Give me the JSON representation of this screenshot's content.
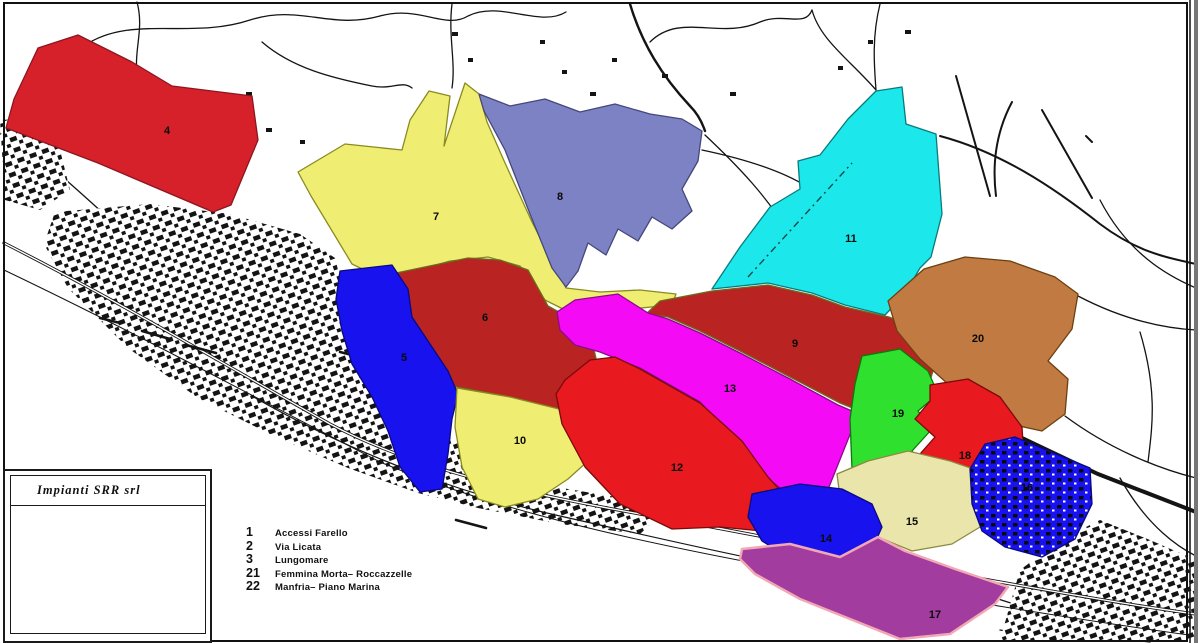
{
  "legend": {
    "title": "Impianti SRR srl",
    "items": [
      {
        "num": "1",
        "label": "Accessi Farello"
      },
      {
        "num": "2",
        "label": "Via Licata"
      },
      {
        "num": "3",
        "label": "Lungomare"
      },
      {
        "num": "21",
        "label": "Femmina Morta– Roccazzelle"
      },
      {
        "num": "22",
        "label": "Manfria– Piano Marina"
      }
    ]
  },
  "map": {
    "frame_color": "#1a1a1a",
    "zones": [
      {
        "id": "7",
        "number": "7",
        "color": "#f0ee72",
        "stroke": "#8a8a20",
        "lx": 436,
        "ly": 220,
        "points": "298,172 345,144 402,150 410,120 429,91 450,96 444,146 465,83 479,94 487,122 505,163 532,222 553,263 566,288 600,292 640,290 676,294 672,305 620,310 578,316 561,308 545,300 520,266 488,257 450,261 415,271 385,280 352,264 311,196"
      },
      {
        "id": "8",
        "number": "8",
        "color": "#7c82c4",
        "stroke": "#44487a",
        "lx": 560,
        "ly": 200,
        "points": "479,94 510,106 545,99 580,112 615,104 650,114 682,119 702,131 698,161 682,189 692,211 672,229 652,217 638,241 618,229 606,255 588,243 578,271 566,287 552,268 530,214 505,150 484,111"
      },
      {
        "id": "11",
        "number": "11",
        "color": "#1ce8ec",
        "stroke": "#0a7a7a",
        "lx": 851,
        "ly": 242,
        "points": "876,91 902,87 906,124 936,134 942,214 931,257 920,268 905,294 885,315 845,305 812,293 768,283 712,289 740,247 770,207 800,189 798,161 820,155 848,119"
      },
      {
        "id": "4",
        "number": "4",
        "color": "#d6202a",
        "stroke": "#8c1620",
        "lx": 167,
        "ly": 134,
        "points": "38,48 78,35 132,62 172,86 252,96 258,140 231,205 213,212 98,163 6,128 14,99"
      },
      {
        "id": "6",
        "number": "6",
        "color": "#b92423",
        "stroke": "#6b6b1f",
        "lx": 485,
        "ly": 321,
        "points": "363,280 420,268 468,258 500,260 528,270 548,306 575,321 592,341 598,367 588,383 566,381 563,410 510,397 457,387 420,377 400,354 382,317"
      },
      {
        "id": "5",
        "number": "5",
        "color": "#1712ee",
        "stroke": "#0a0a80",
        "lx": 404,
        "ly": 361,
        "points": "340,271 392,265 408,289 412,317 430,344 448,371 458,394 452,419 448,454 442,489 420,492 400,467 388,431 372,397 352,364 342,331 336,299"
      },
      {
        "id": "9",
        "number": "9",
        "color": "#b92423",
        "stroke": "#6b6b1f",
        "lx": 795,
        "ly": 347,
        "points": "712,291 768,285 812,295 845,307 889,317 920,329 940,347 930,381 903,397 885,421 840,403 790,377 740,351 700,331 668,317 646,314 660,301"
      },
      {
        "id": "20",
        "number": "20",
        "color": "#c17a41",
        "stroke": "#6b4010",
        "lx": 978,
        "ly": 342,
        "points": "888,301 924,269 965,257 1010,261 1055,277 1078,294 1072,329 1048,361 1068,379 1065,414 1042,431 1010,424 978,407 948,384 920,359 897,331"
      },
      {
        "id": "13",
        "number": "13",
        "color": "#f50af5",
        "stroke": "#8a0a8a",
        "lx": 730,
        "ly": 392,
        "points": "575,300 618,294 648,313 668,319 700,333 740,353 790,379 838,405 880,423 853,427 827,492 795,500 770,480 745,450 700,402 640,368 600,352 575,345 560,330 557,312"
      },
      {
        "id": "10",
        "number": "10",
        "color": "#f0ee72",
        "stroke": "#8a8a20",
        "lx": 520,
        "ly": 444,
        "points": "457,388 510,397 563,410 588,407 596,431 588,461 568,479 538,499 505,507 478,499 462,467 455,427"
      },
      {
        "id": "12",
        "number": "12",
        "color": "#e8191f",
        "stroke": "#7a0a0a",
        "lx": 677,
        "ly": 471,
        "points": "565,380 590,360 615,357 640,369 700,403 742,441 768,477 790,501 762,531 720,527 672,529 620,504 585,467 562,424 556,394"
      },
      {
        "id": "19",
        "number": "19",
        "color": "#30e02e",
        "stroke": "#0a7a0a",
        "lx": 898,
        "ly": 417,
        "points": "862,356 900,349 928,371 938,394 918,411 932,429 912,451 928,469 905,491 885,511 868,531 858,509 852,469 850,419 855,384"
      },
      {
        "id": "18",
        "number": "18",
        "color": "#e8191f",
        "stroke": "#7a0a0a",
        "lx": 965,
        "ly": 459,
        "points": "930,385 968,379 1000,397 1022,427 1024,459 1005,489 972,499 940,491 938,469 920,454 935,437 915,419 930,401"
      },
      {
        "id": "15",
        "number": "15",
        "color": "#eae5ab",
        "stroke": "#8a8a40",
        "lx": 912,
        "ly": 525,
        "points": "837,474 868,461 908,451 950,461 988,474 1000,497 985,524 952,544 912,551 878,537 855,514 840,497"
      },
      {
        "id": "16",
        "number": "16",
        "color": "#1712ee",
        "stroke": "#0a0a80",
        "speckled": true,
        "lx": 1027,
        "ly": 491,
        "points": "1015,437 1090,468 1092,504 1075,539 1042,557 1005,547 982,531 972,504 970,469 985,444"
      },
      {
        "id": "14",
        "number": "14",
        "color": "#1712ee",
        "stroke": "#0a0a80",
        "lx": 826,
        "ly": 542,
        "points": "752,494 800,484 842,489 872,504 882,527 870,554 893,579 878,601 855,591 838,567 815,551 788,557 762,541 748,517"
      },
      {
        "id": "17",
        "number": "17",
        "color": "#a23c9e",
        "stroke": "#f2a8b4",
        "strokeWidth": 2.5,
        "lx": 935,
        "ly": 618,
        "points": "742,549 790,544 840,557 878,537 905,551 955,569 1008,587 995,604 950,634 900,639 850,619 800,599 755,574 740,559"
      }
    ]
  }
}
